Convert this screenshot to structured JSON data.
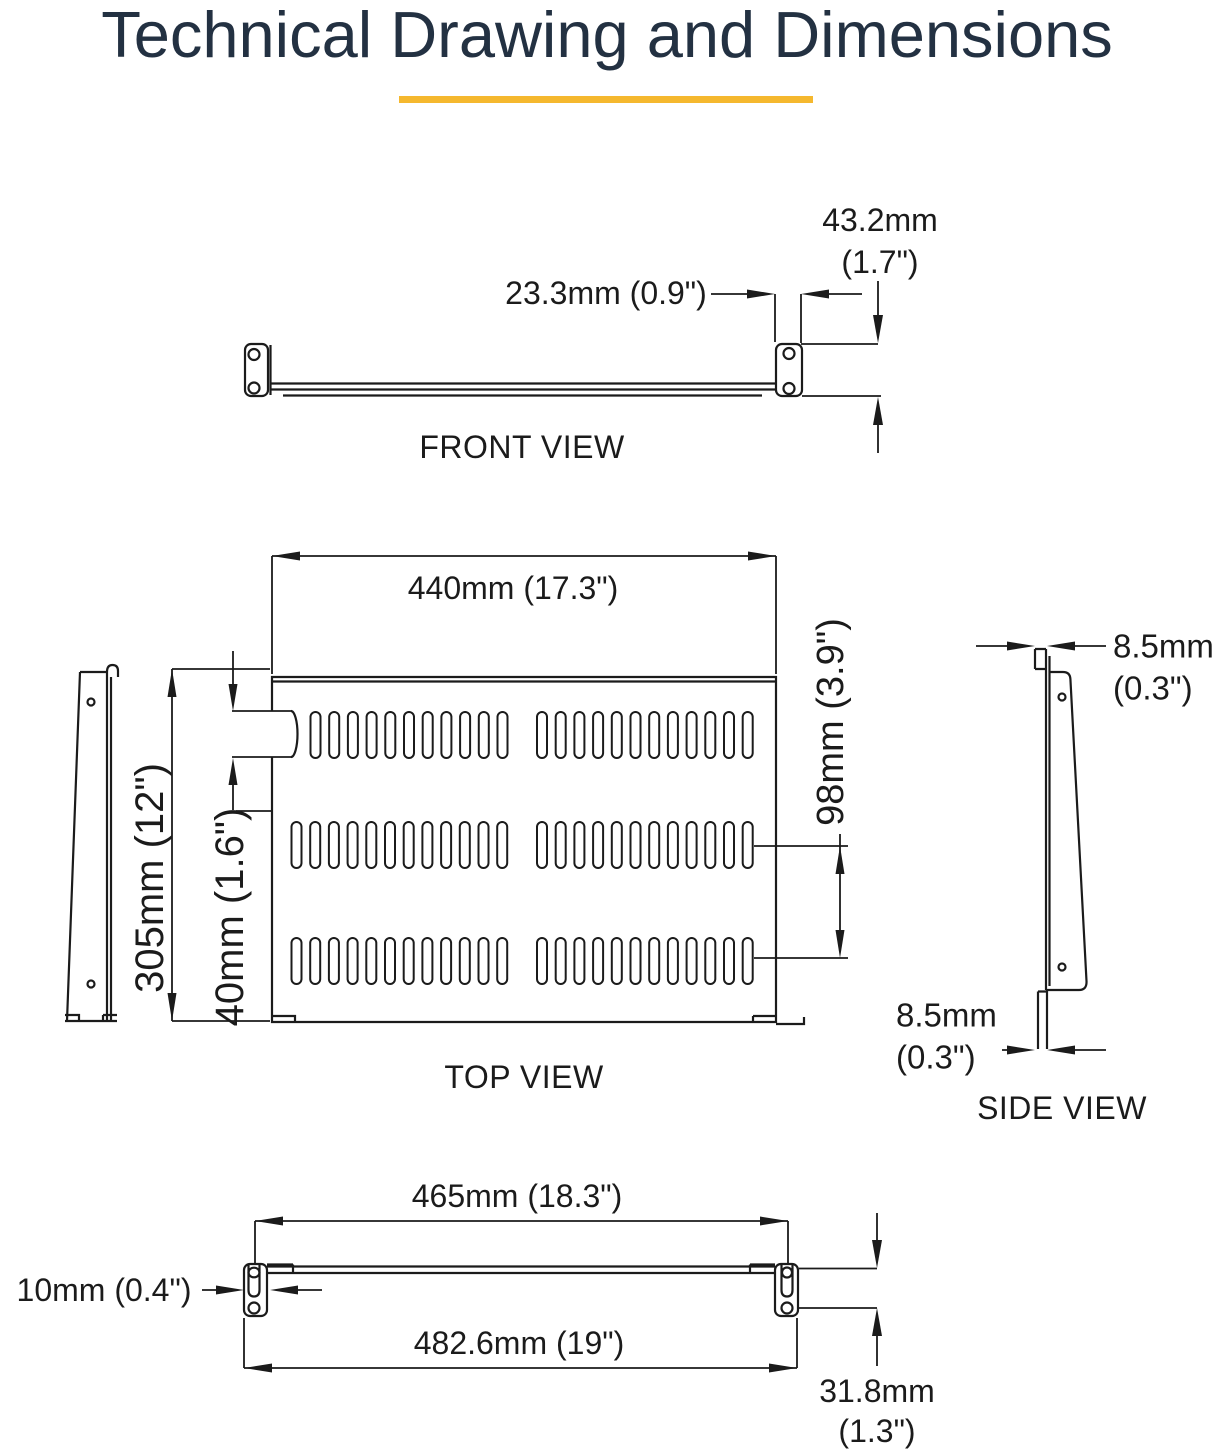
{
  "page": {
    "background": "#ffffff"
  },
  "title": {
    "text": "Technical Drawing and Dimensions",
    "color": "#233142",
    "underline_color": "#F5B82E"
  },
  "drawing": {
    "line_color": "#1b1b1b"
  },
  "front_view": {
    "label": "FRONT VIEW",
    "dim_flange_depth": "23.3mm (0.9\")",
    "dim_height_mm": "43.2mm",
    "dim_height_in": "(1.7\")"
  },
  "top_view": {
    "label": "TOP VIEW",
    "dim_width": "440mm (17.3\")",
    "dim_depth": "305mm (12\")",
    "dim_notch": "40mm (1.6\")",
    "dim_vent_spacing": "98mm (3.9\")"
  },
  "side_view": {
    "label": "SIDE VIEW",
    "dim_top_lip_mm": "8.5mm",
    "dim_top_lip_in": "(0.3\")",
    "dim_bottom_lip_mm": "8.5mm",
    "dim_bottom_lip_in": "(0.3\")"
  },
  "bottom_view": {
    "dim_inner_width": "465mm (18.3\")",
    "dim_bracket_width": "10mm (0.4\")",
    "dim_outer_width": "482.6mm (19\")",
    "dim_height_mm": "31.8mm",
    "dim_height_in": "(1.3\")"
  }
}
